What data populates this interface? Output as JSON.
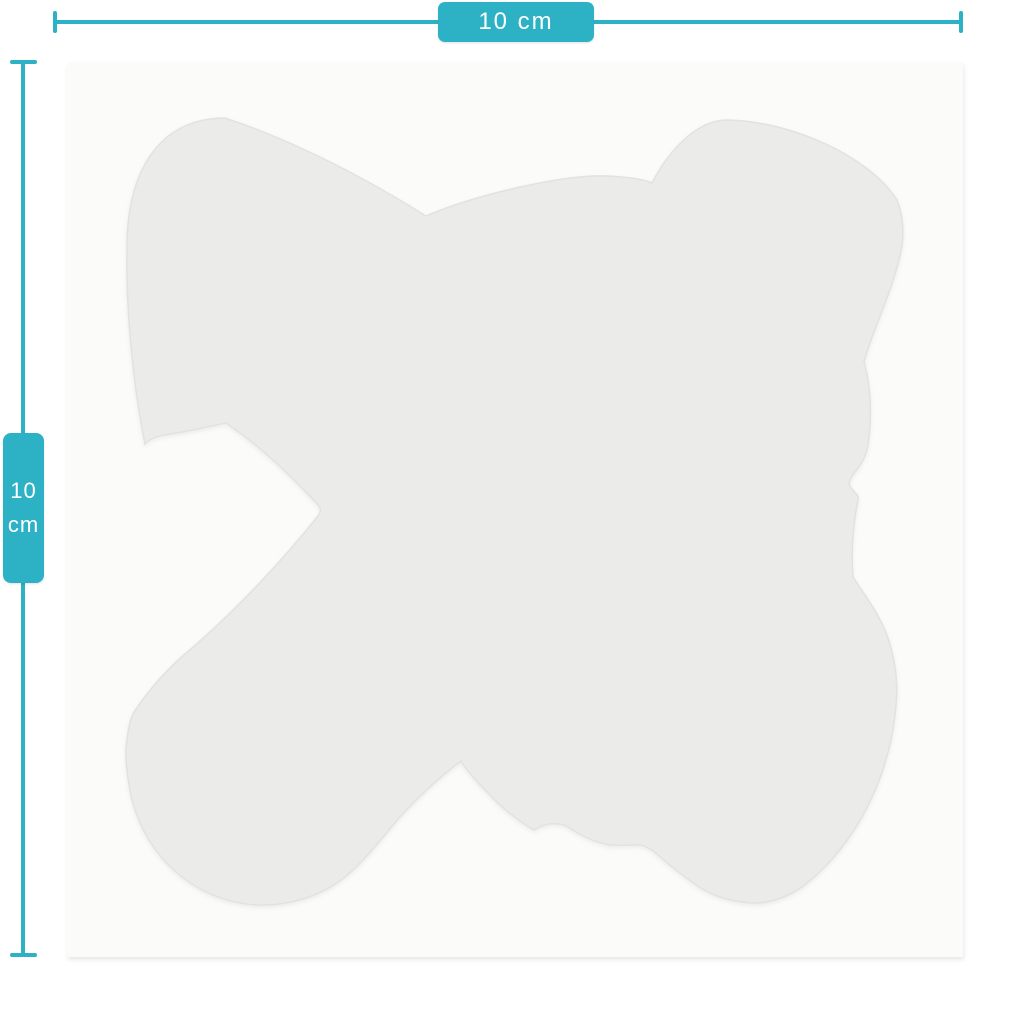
{
  "figure": {
    "page_background": "#ffffff",
    "accent_color": "#2db1c5",
    "square_color": "#fbfbfa",
    "sticker_color": "#ebebe9",
    "sticker_edge_color": "#e2e2e0"
  },
  "dimensions": {
    "width_label": "10 cm",
    "height_value": "10",
    "height_unit": "cm"
  }
}
